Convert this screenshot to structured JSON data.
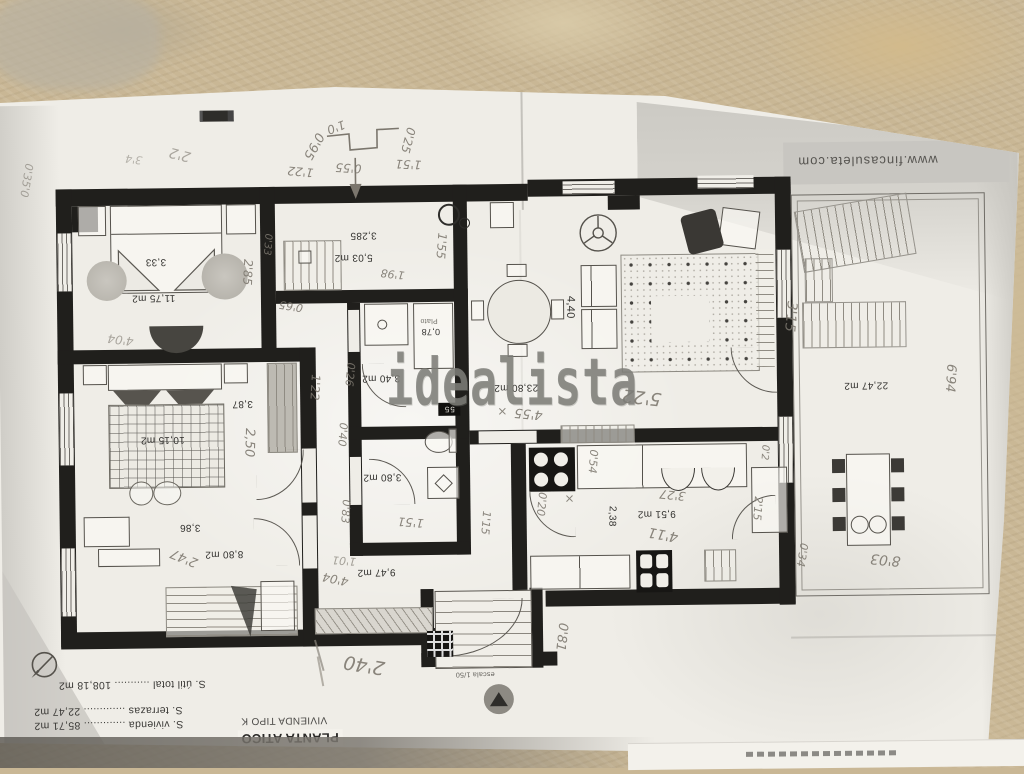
{
  "scene": {
    "kind": "photo of a photocopied apartment floor plan (plan printed upside-down in the photo)",
    "colors": {
      "table": "#c9b795",
      "paper": "#efede7",
      "ink": "#201f1c",
      "pencil": "#7b766d",
      "watermark": "#7d7d78",
      "shade": "#c8c6c1"
    }
  },
  "watermark": {
    "text": "idealista"
  },
  "header": {
    "website": "www.fincasuleta.com"
  },
  "title_block": {
    "heading": "PLANTA ATICO",
    "subheading": "VIVIENDA TIPO K",
    "legend_lines": [
      "S. vivienda ............. 85,71 m2",
      "S. terrazas ............. 22,47 m2",
      "S. útil total ........... 108,18 m2"
    ]
  },
  "scale_note": "escala 1/50",
  "stamp": {
    "text": "55"
  },
  "rooms": {
    "bedroom1": {
      "area": "11,75 m2",
      "dim": "3,33"
    },
    "study": {
      "area": "5,03 m2",
      "dim": "3,285"
    },
    "shower_room": {
      "area": "0,78",
      "fixture": "Plato"
    },
    "hall": {
      "area": "3,40 m2"
    },
    "bedroom2": {
      "area": "10,15 m2",
      "dim": "3,87"
    },
    "bathroom": {
      "area": "3,80 m2"
    },
    "bedroom3": {
      "area": "8,80 m2",
      "dim": "3,86"
    },
    "entry": {
      "area": "9,47 m2"
    },
    "kitchen": {
      "area": "9,51 m2",
      "dim": "2,38"
    },
    "living": {
      "area": "23,80 m2",
      "dim": "4,40"
    },
    "terrace": {
      "area": "22,47 m2"
    }
  },
  "pencil": {
    "sketch_a": "0'95",
    "sketch_b": "1'0",
    "sketch_c": "0'25",
    "margin_a": "2'2",
    "margin_b": "0'35'0",
    "margin_c": "3'4",
    "bed1_side": "2'85",
    "bed1_width": "4'04",
    "study_top_a": "1'22",
    "study_top_b": "0'55",
    "study_top_c": "1'51",
    "study_right": "1'55",
    "study_mid": "1'98",
    "study_left": "0'65",
    "study_small": "0'33",
    "hall_a": "1'22",
    "hall_b": "0'26",
    "hall_c": "0'40",
    "bath_left": "0'83",
    "bath_bottom": "1'51",
    "bath_right": "1'15",
    "bed2_depth": "2,50",
    "bed3_diag": "2'47",
    "entry_a": "4'04",
    "entry_b": "1'01",
    "stairs_side": "0'81",
    "bottom_width": "2'40",
    "kitchen_a": "3'27",
    "kitchen_b": "4'11",
    "kitchen_c": "0'20",
    "kitchen_x": "×",
    "kitchen_d": "0'54",
    "kitchen_e": "2'15",
    "kitchen_f": "0'2",
    "living_x": "×",
    "living_a": "4'55",
    "living_b": "5'22",
    "terrace_left": "3'15",
    "terrace_right": "6'94",
    "terrace_bottom": "8'03",
    "terrace_edge": "0'34"
  }
}
